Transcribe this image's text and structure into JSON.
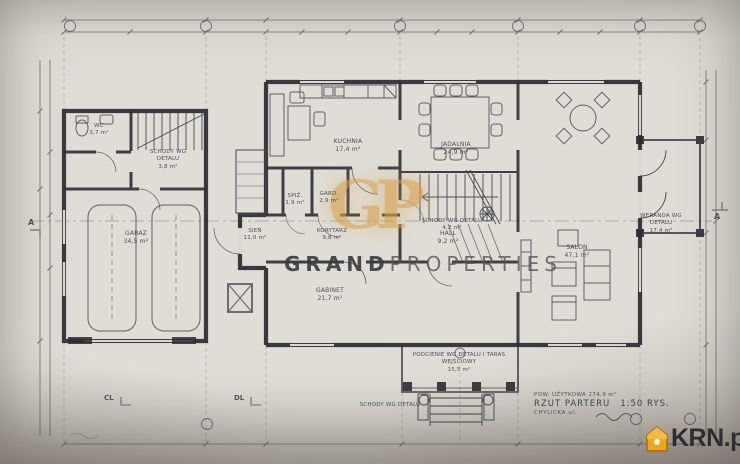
{
  "watermark": {
    "word1": "GRAND",
    "word2": "PROPERTIES",
    "monogram": "GP",
    "gold_color": "#d8a24b"
  },
  "branding": {
    "logo_text": "KRN.pl",
    "logo_color": "#f0a61c"
  },
  "title_block": {
    "area_label": "POW. UŻYTKOWA 274,9 m²",
    "drawing_title": "RZUT PARTERU",
    "scale": "1:50 RYS.",
    "location": "CHYLICKA ul."
  },
  "rooms": {
    "wc": {
      "name": "WC",
      "area": "3,7 m²"
    },
    "schody_lewe": {
      "name": "SCHODY WG DETALU",
      "area": "3,8 m²"
    },
    "garaz": {
      "name": "GARAŻ",
      "area": "34,5 m²"
    },
    "sien": {
      "name": "SIEŃ",
      "area": "11,0 m²"
    },
    "spiz": {
      "name": "SPIŻ.",
      "area": "1,9 m²"
    },
    "gard": {
      "name": "GARD.",
      "area": "2,9 m²"
    },
    "korytarz": {
      "name": "KORYTARZ",
      "area": "9,8 m²"
    },
    "kuchnia": {
      "name": "KUCHNIA",
      "area": "17,4 m²"
    },
    "jadalnia": {
      "name": "JADALNIA",
      "area": "24,9 m²"
    },
    "schody_glowne": {
      "name": "SCHODY WG DETALU",
      "area": "4,2 m²"
    },
    "hall": {
      "name": "HALL",
      "area": "9,2 m²"
    },
    "gabinet": {
      "name": "GABINET",
      "area": "21,7 m²"
    },
    "salon": {
      "name": "SALON",
      "area": "47,1 m²"
    },
    "weranda": {
      "name": "WERANDA WG DETALU",
      "area": "17,4 m²"
    },
    "taras": {
      "name": "PODCIENIE WG DETALU I TARAS WEJŚCIOWY",
      "area": "15,5 m²"
    },
    "schody_wejsciowe": {
      "name": "SCHODY WG DETALU",
      "area": ""
    }
  },
  "markers": {
    "axis_c": "CL",
    "axis_d": "DL",
    "section_left": "A",
    "section_right": "A"
  }
}
